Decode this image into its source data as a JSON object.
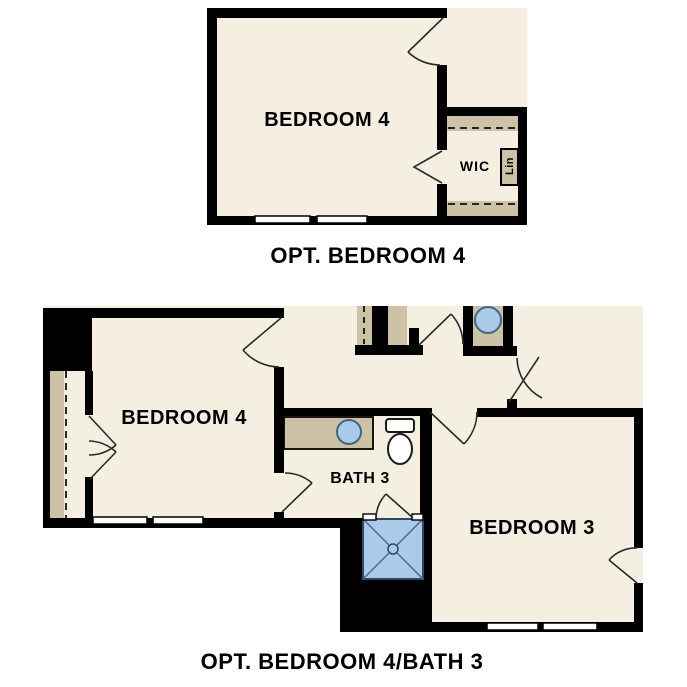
{
  "document_type": "floor-plan options sheet",
  "colors": {
    "background": "#ffffff",
    "wall": "#000000",
    "floor": "#f5efe2",
    "shelf_tan": "#cdc2a6",
    "fixture_blue": "#a9cae8",
    "fixture_blue_stroke": "#44667f",
    "fixture_outline": "#1a1a1a",
    "door_line": "#2a2a2a",
    "window_fill": "#ffffff"
  },
  "plan_top": {
    "caption": "OPT. BEDROOM 4",
    "room_label": "BEDROOM 4",
    "closet_label": "WIC",
    "linen_label": "Lin"
  },
  "plan_bottom": {
    "caption": "OPT. BEDROOM 4/BATH 3",
    "bedroom4_label": "BEDROOM 4",
    "bath_label": "BATH 3",
    "bedroom3_label": "BEDROOM 3"
  }
}
